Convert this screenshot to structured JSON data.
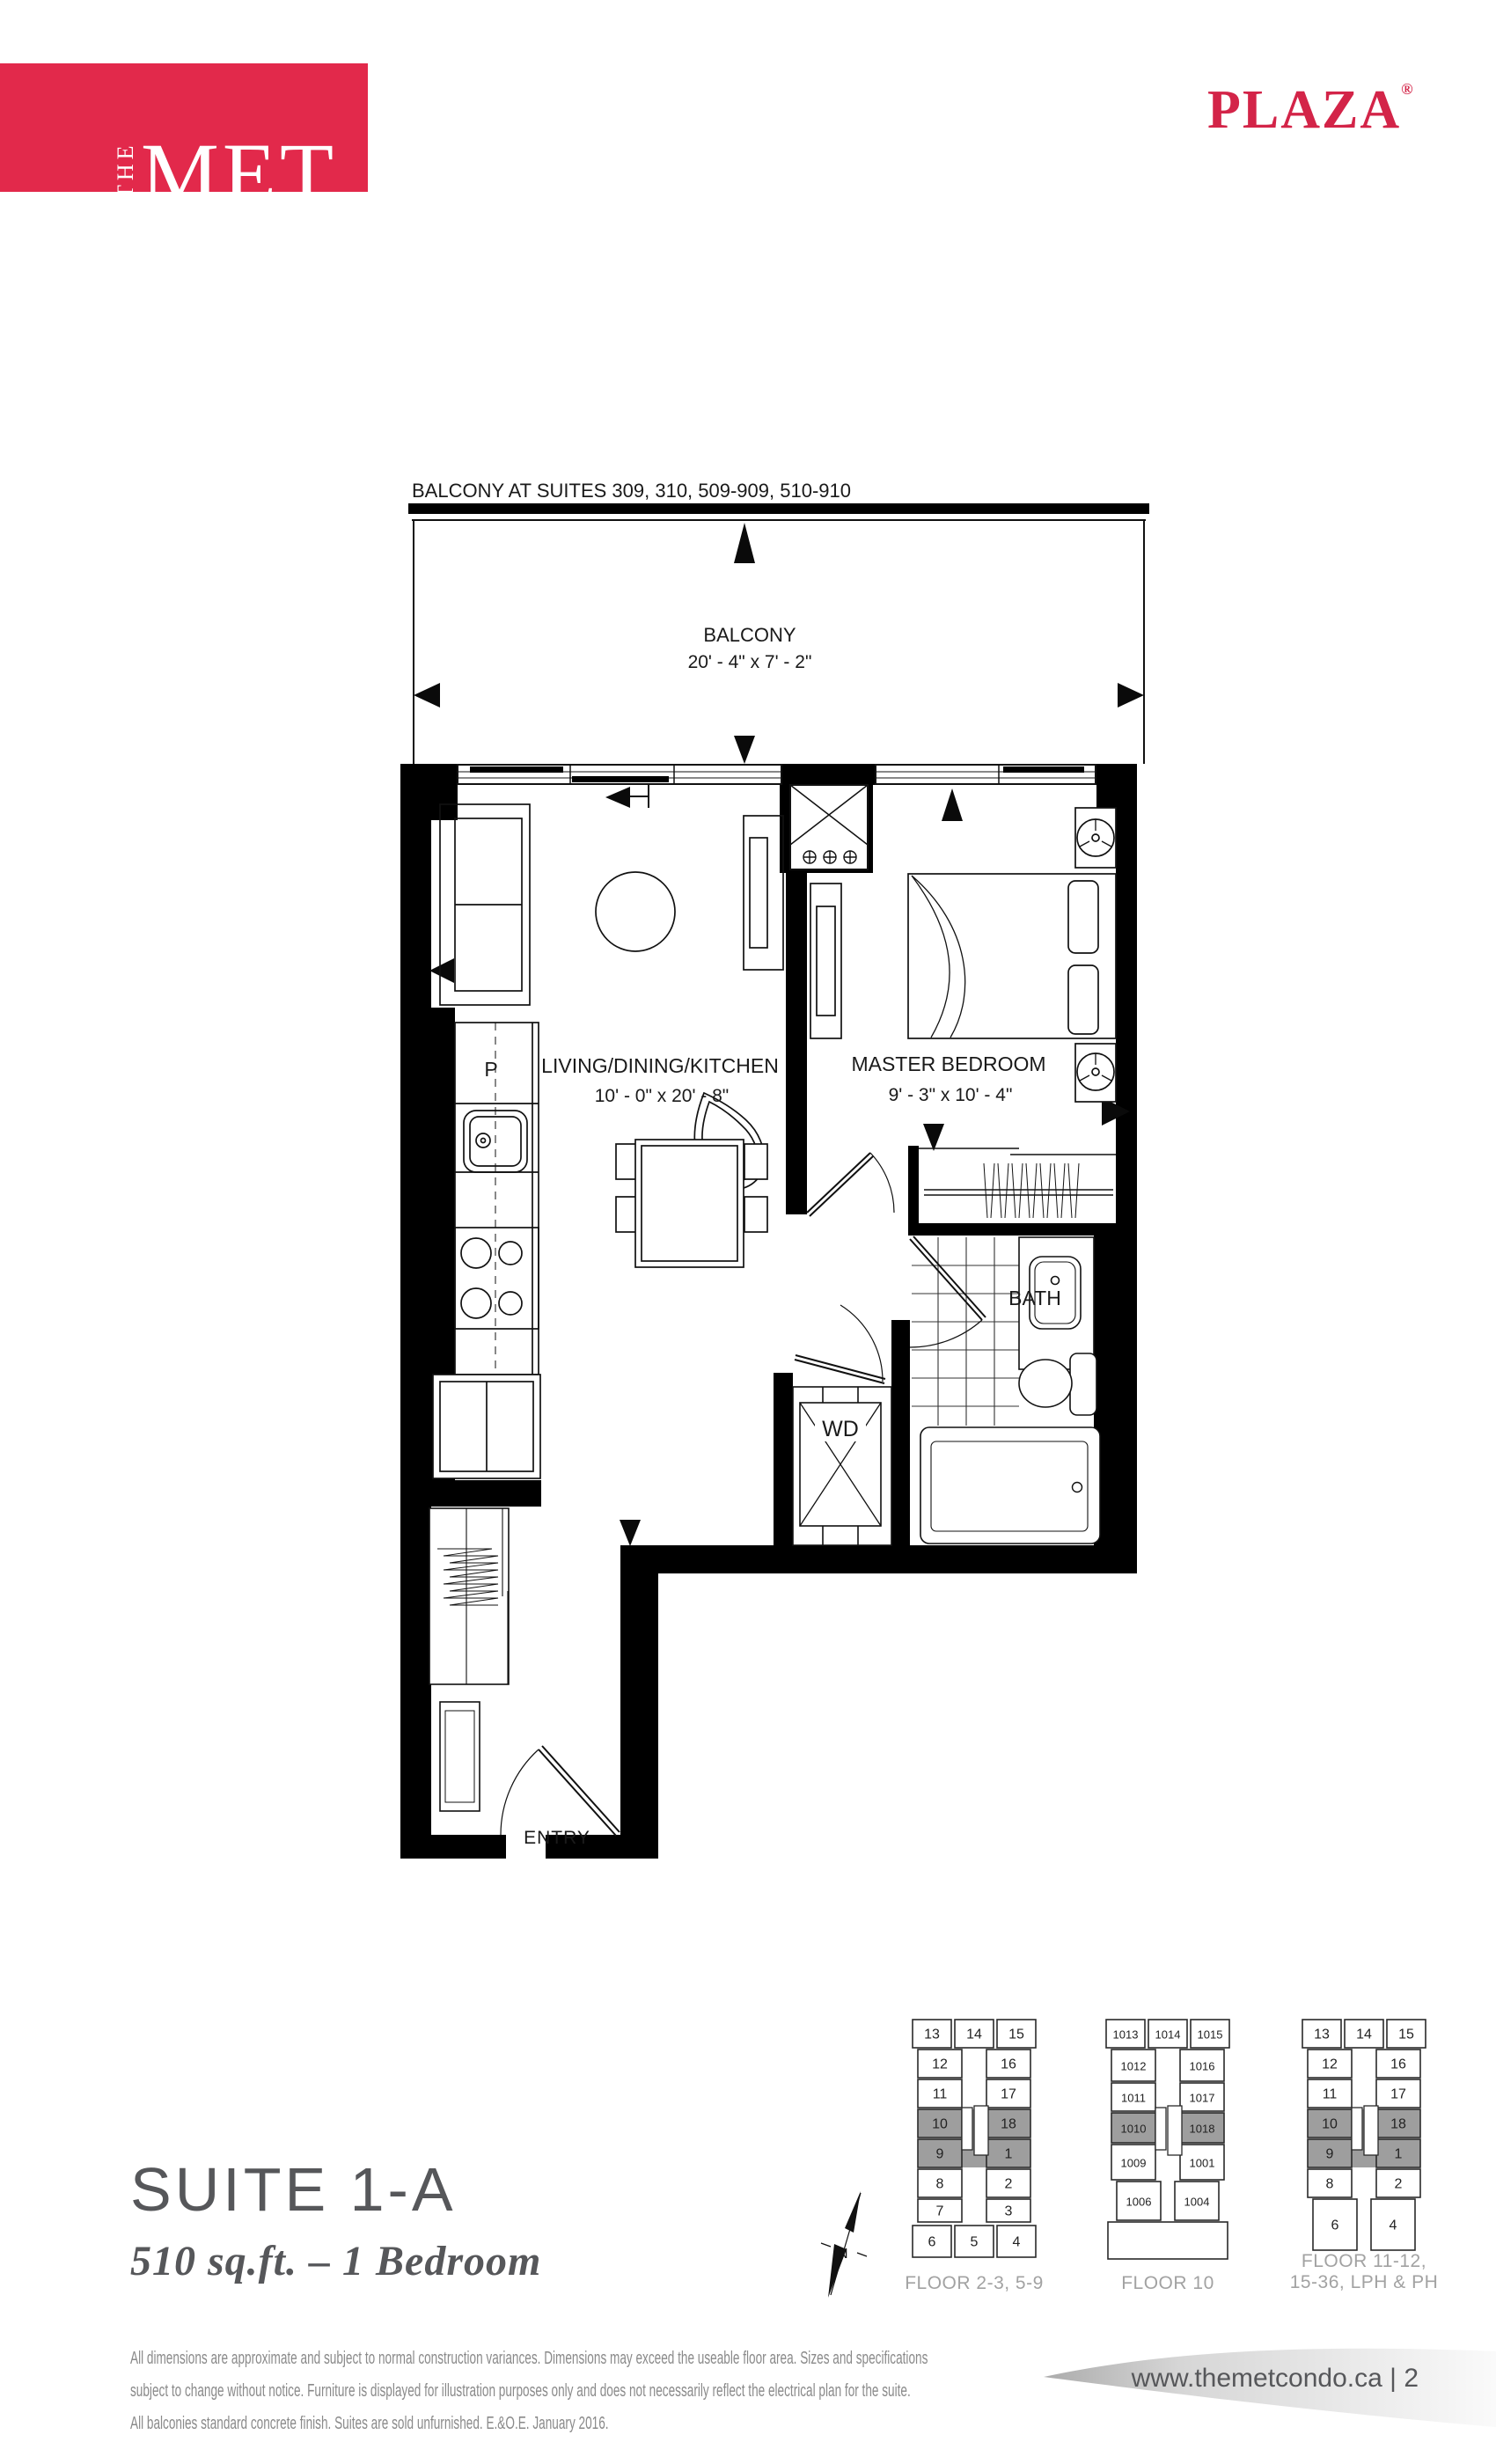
{
  "brand": {
    "logo": {
      "the": "THE",
      "met": "MET",
      "tagline": "AT VAUGHAN METROPOLITAN CENTRE",
      "bg_color": "#E2294B",
      "text_color": "#FFFFFF"
    },
    "plaza": {
      "text": "PLAZA",
      "registered": "®",
      "color": "#D32448"
    }
  },
  "floor_plan": {
    "balcony_note": "BALCONY AT SUITES 309, 310, 509-909, 510-910",
    "balcony": {
      "label": "BALCONY",
      "dims": "20' - 4\"  x  7' - 2\""
    },
    "living": {
      "label": "LIVING/DINING/KITCHEN",
      "dims": "10' - 0\"  x  20' - 8\""
    },
    "bedroom": {
      "label": "MASTER BEDROOM",
      "dims": "9' - 3\"  x  10' - 4\""
    },
    "labels": {
      "pantry": "P",
      "washer_dryer": "WD",
      "bath": "BATH",
      "entry": "ENTRY"
    }
  },
  "suite": {
    "name": "SUITE 1-A",
    "details": "510 sq.ft. – 1 Bedroom"
  },
  "disclaimer": {
    "lines": [
      "All dimensions are approximate and subject to normal construction variances. Dimensions may exceed the useable floor area. Sizes and specifications",
      "subject to change without notice. Furniture is displayed for illustration purposes only and does not necessarily reflect the electrical plan for the suite.",
      "All balconies standard concrete finish. Suites are sold unfurnished. E.&O.E. January 2016."
    ]
  },
  "compass": {
    "label": "N"
  },
  "keyplans": [
    {
      "title_lines": [
        "FLOOR 2-3, 5-9"
      ],
      "units": {
        "top": [
          "13",
          "14",
          "15"
        ],
        "left": [
          "12",
          "11",
          "10",
          "9",
          "8",
          "7"
        ],
        "right": [
          "16",
          "17",
          "18",
          "1",
          "2",
          "3"
        ],
        "bottom": [
          "6",
          "5",
          "4"
        ]
      },
      "shaded": [
        "10",
        "9",
        "18",
        "1"
      ],
      "shaded_color": "#9e9e9e"
    },
    {
      "title_lines": [
        "FLOOR 10"
      ],
      "units": {
        "top": [
          "1013",
          "1014",
          "1015"
        ],
        "left": [
          "1012",
          "1011",
          "1010",
          "1009",
          "1006"
        ],
        "right": [
          "1016",
          "1017",
          "1018",
          "1001",
          "1004"
        ],
        "bottom": []
      },
      "shaded": [
        "1010",
        "1018"
      ],
      "shaded_color": "#9e9e9e"
    },
    {
      "title_lines": [
        "FLOOR 11-12,",
        "15-36, LPH & PH"
      ],
      "units": {
        "top": [
          "13",
          "14",
          "15"
        ],
        "left": [
          "12",
          "11",
          "10",
          "9",
          "8",
          "6"
        ],
        "right": [
          "16",
          "17",
          "18",
          "1",
          "2",
          "4"
        ],
        "bottom": []
      },
      "shaded": [
        "10",
        "9",
        "18",
        "1"
      ],
      "shaded_color": "#9e9e9e"
    }
  ],
  "footer": {
    "site": "www.themetcondo.ca",
    "separator": "|",
    "page": "2"
  }
}
